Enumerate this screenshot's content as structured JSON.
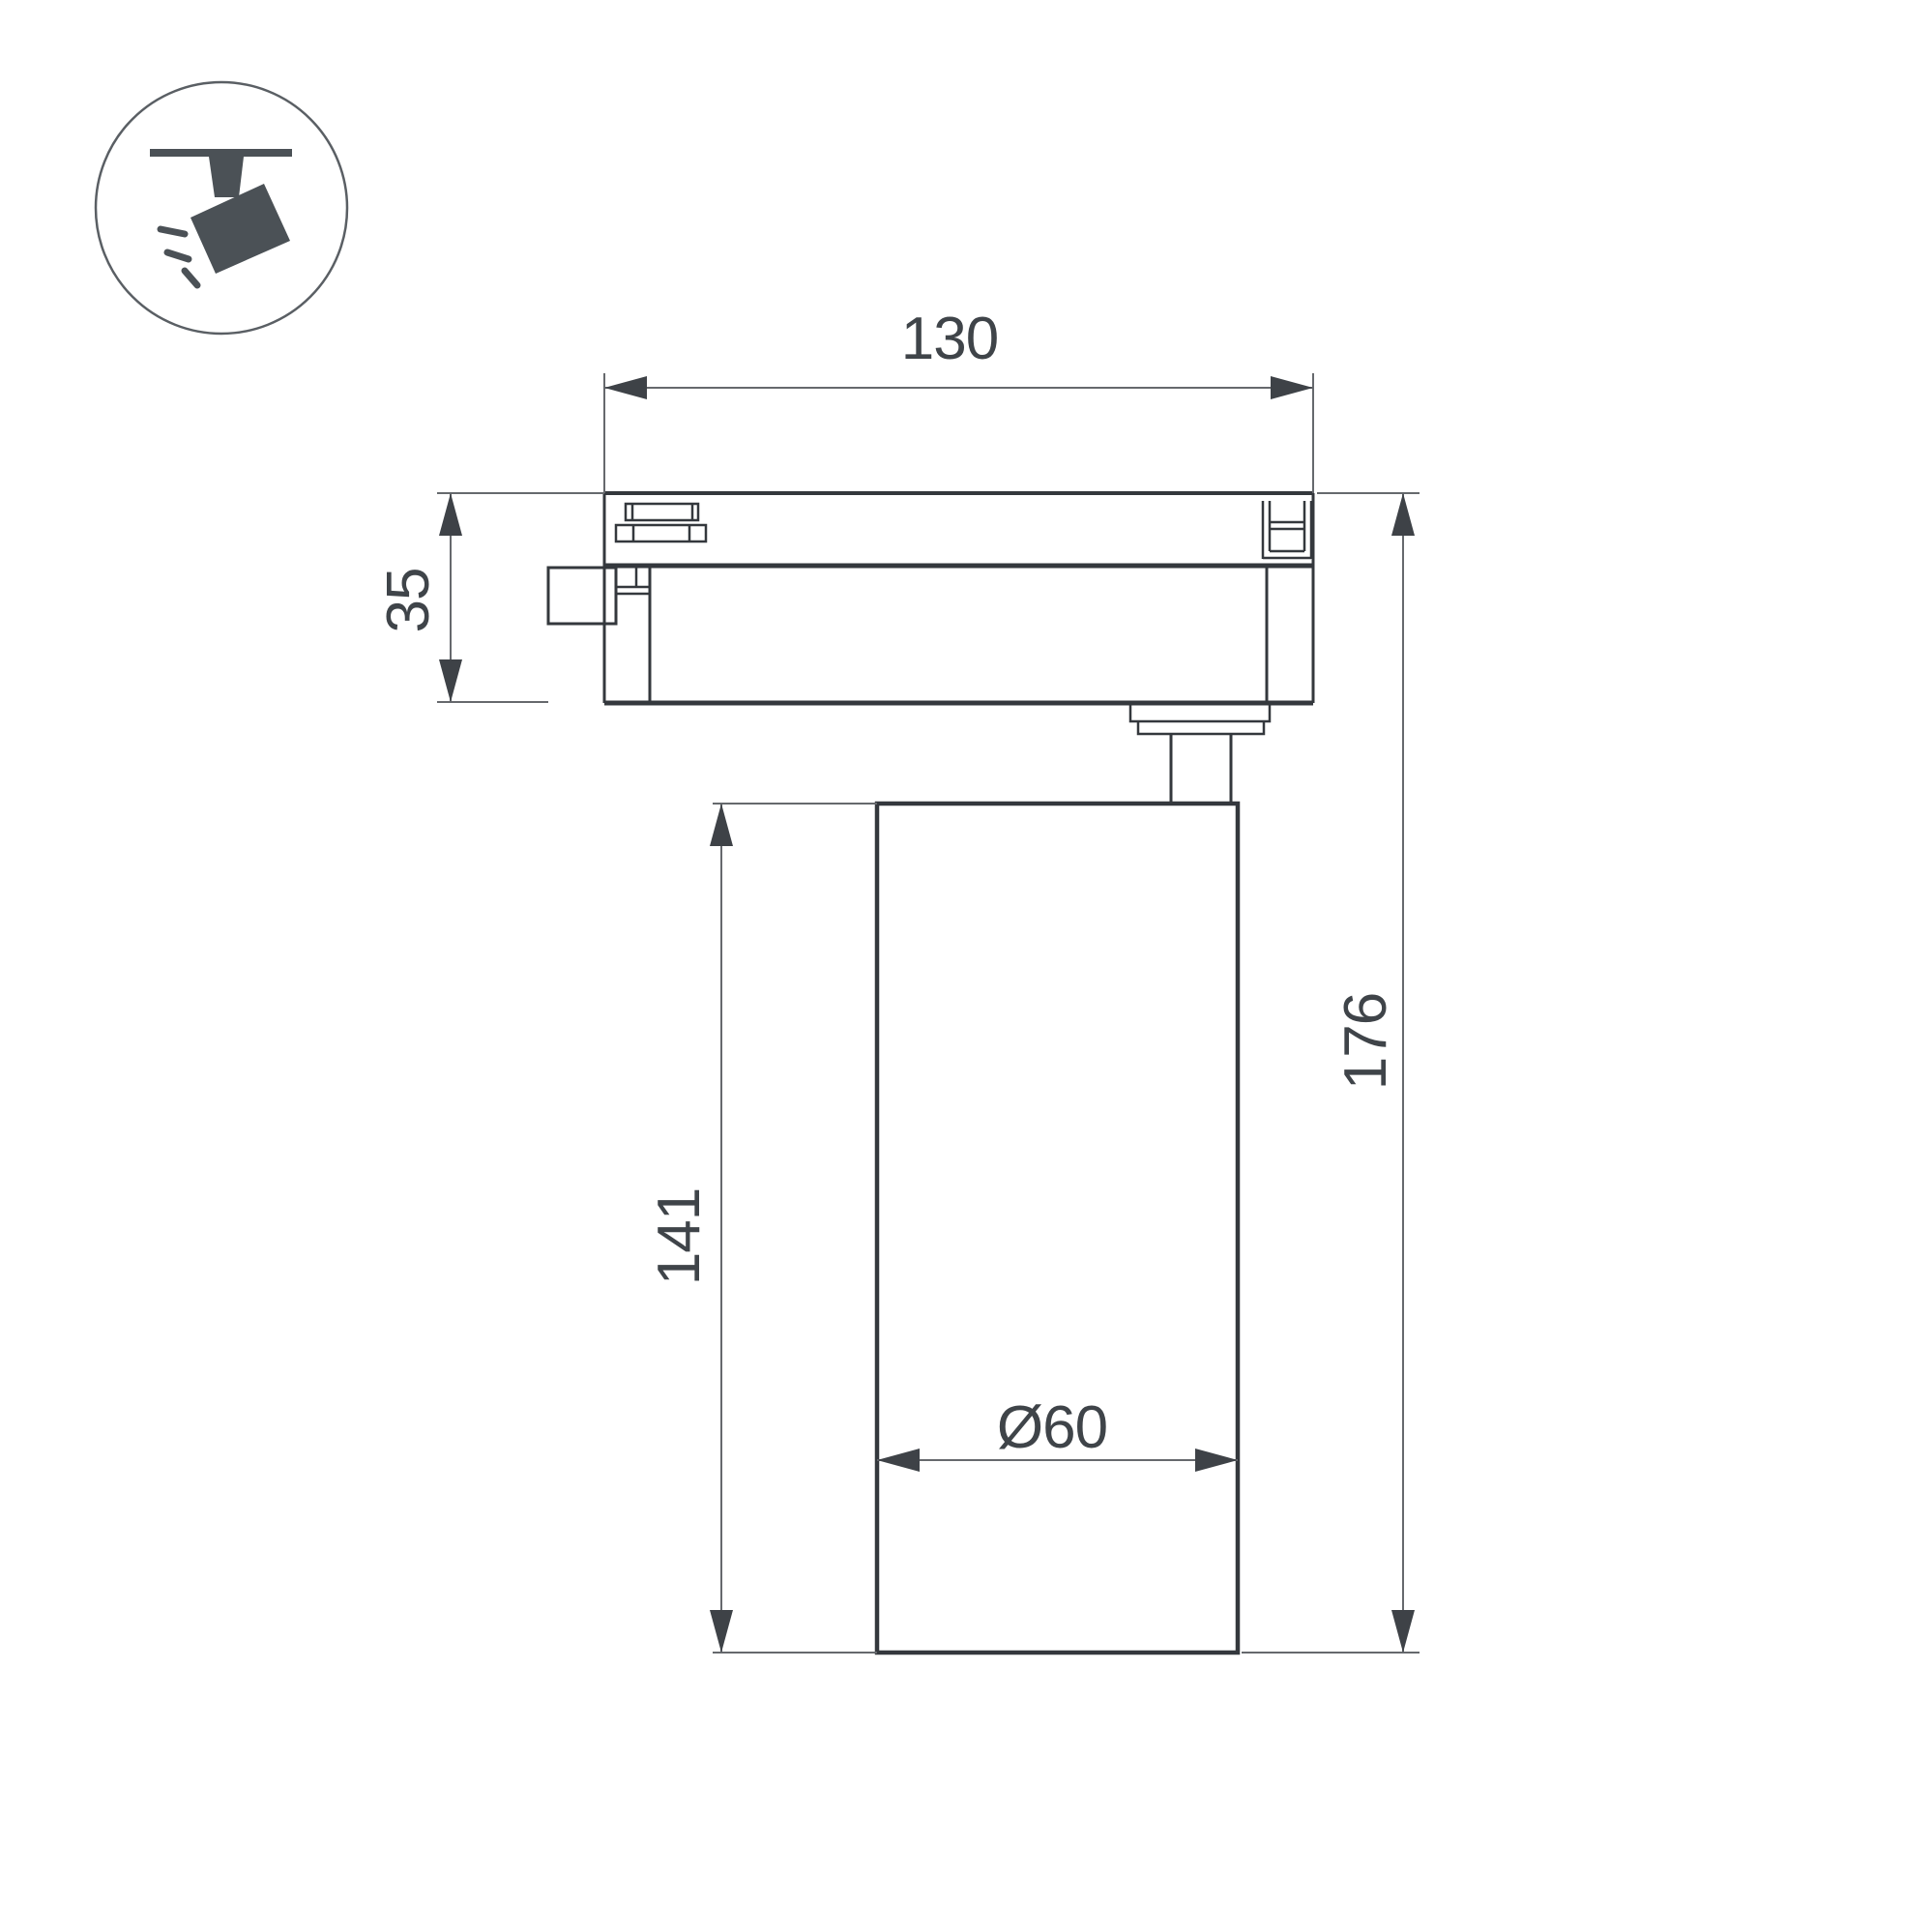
{
  "document": {
    "kind": "technical dimension drawing",
    "views": "side view of track-mounted spotlight with track adapter, mounting neck and cylindrical lamp body"
  },
  "icon": {
    "name": "track-spotlight-icon",
    "depicts": "ceiling track with tilted spotlight head emitting light rays"
  },
  "dimensions": {
    "track_width": {
      "label": "130"
    },
    "adapter_height": {
      "label": "35"
    },
    "body_height": {
      "label": "141"
    },
    "total_height": {
      "label": "176"
    },
    "body_diameter": {
      "label": "Ø60"
    }
  },
  "palette": {
    "background": "#ffffff",
    "drawing_line": "#34383d",
    "dimension_line": "#66696d",
    "arrow_fill": "#3e4247",
    "text": "#3f4449",
    "icon_fill": "#4b5156",
    "icon_circle_outline": "#5a5f64"
  }
}
